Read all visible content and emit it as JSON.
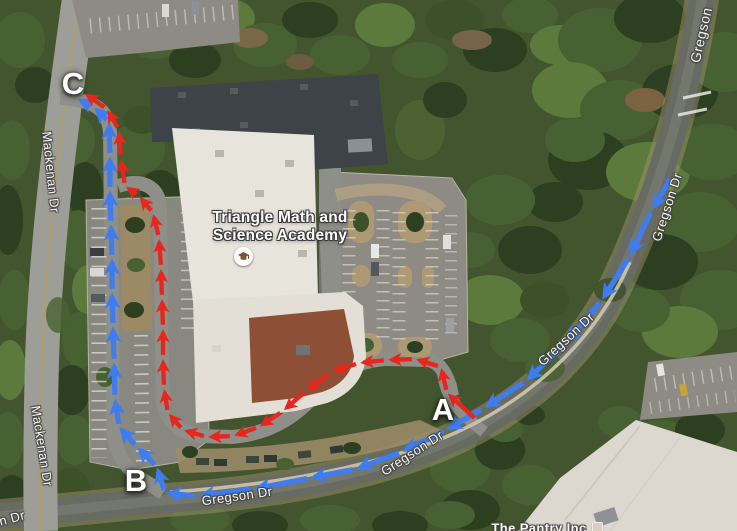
{
  "map": {
    "poi": {
      "school": {
        "name_line1": "Triangle Math and",
        "name_line2": "Science Academy",
        "icon": "graduation-cap-icon"
      },
      "pantry": {
        "name": "The Pantry Inc",
        "icon": "building-square-icon"
      }
    },
    "street_labels": [
      {
        "text": "Gregson"
      },
      {
        "text": "Gregson Dr"
      },
      {
        "text": "Gregson Dr"
      },
      {
        "text": "Gregson Dr"
      },
      {
        "text": "Gregson Dr"
      },
      {
        "text": "Mackenan Dr"
      },
      {
        "text": "Mackenan Dr"
      },
      {
        "text": "n Dr"
      }
    ],
    "route_markers": {
      "a": {
        "label": "A"
      },
      "b": {
        "label": "B"
      },
      "c": {
        "label": "C"
      }
    },
    "routes": {
      "blue": {
        "id": "blue",
        "color": "#3e7cf0",
        "width": 5.2,
        "points": [
          [
            672,
            176
          ],
          [
            652,
            210
          ],
          [
            630,
            256
          ],
          [
            602,
            300
          ],
          [
            566,
            343
          ],
          [
            526,
            381
          ],
          [
            484,
            408
          ],
          [
            446,
            430
          ],
          [
            402,
            452
          ],
          [
            356,
            469
          ],
          [
            310,
            478
          ],
          [
            254,
            489
          ],
          [
            198,
            496
          ],
          [
            165,
            493
          ],
          [
            157,
            467
          ],
          [
            137,
            447
          ],
          [
            119,
            427
          ],
          [
            115,
            398
          ],
          [
            114,
            362
          ],
          [
            113,
            326
          ],
          [
            112,
            292
          ],
          [
            112,
            258
          ],
          [
            111,
            224
          ],
          [
            110,
            190
          ],
          [
            110,
            156
          ],
          [
            109,
            122
          ],
          [
            94,
            107
          ],
          [
            77,
            99
          ]
        ]
      },
      "red": {
        "id": "red",
        "color": "#e8261d",
        "width": 4.3,
        "points": [
          [
            477,
            420
          ],
          [
            447,
            393
          ],
          [
            441,
            367
          ],
          [
            415,
            359
          ],
          [
            387,
            360
          ],
          [
            359,
            363
          ],
          [
            331,
            372
          ],
          [
            306,
            391
          ],
          [
            283,
            411
          ],
          [
            259,
            427
          ],
          [
            233,
            436
          ],
          [
            207,
            437
          ],
          [
            183,
            430
          ],
          [
            168,
            413
          ],
          [
            164,
            388
          ],
          [
            163,
            358
          ],
          [
            163,
            328
          ],
          [
            162,
            298
          ],
          [
            161,
            268
          ],
          [
            159,
            238
          ],
          [
            153,
            213
          ],
          [
            139,
            196
          ],
          [
            125,
            186
          ],
          [
            121,
            158
          ],
          [
            119,
            130
          ],
          [
            107,
            109
          ],
          [
            84,
            93
          ]
        ]
      }
    }
  }
}
